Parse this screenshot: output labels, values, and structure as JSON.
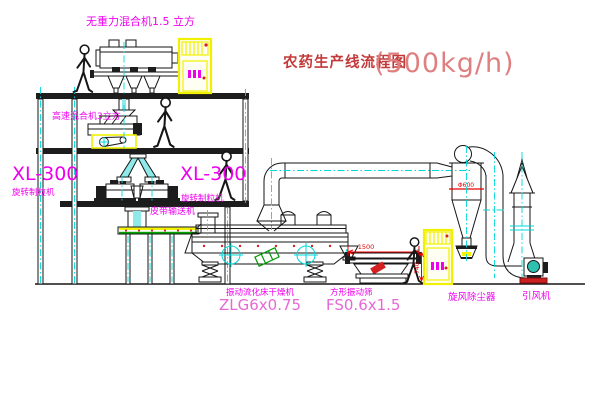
{
  "title": {
    "name_cn": "农药生产线流程图",
    "capacity": "(500kg/h)"
  },
  "equipment_labels": {
    "zero_gravity_mixer": "无重力混合机1.5 立方",
    "high_speed_mixer": "高速混合机3立方",
    "granulator_left": {
      "model": "XL-300",
      "name": "旋转制粒机"
    },
    "granulator_right": {
      "model": "XL-300",
      "name": "旋转制粒机"
    },
    "belt_conveyor": "皮带输送机",
    "fluid_bed_dryer": {
      "name": "振动流化床干燥机",
      "model": "ZLG6x0.75"
    },
    "vibrating_screen": {
      "name": "方形振动筛",
      "model": "FS0.6x1.5"
    },
    "cyclone_dust_collector": "旋风除尘器",
    "induced_draft_fan": "引风机"
  },
  "dimensions": {
    "screen_length_mm": "1500",
    "screen_height_mm": "740",
    "cyclone_marking": "Φ600"
  },
  "colors": {
    "label_magenta": "#ee00ee",
    "model_pink": "#e668d6",
    "title_red": "#c23a3a",
    "capacity_red": "#de8080",
    "dimension_red": "#e80000",
    "centerline_cyan": "#00d8d8",
    "cabinet_yellow": "#f2f200",
    "machine_green": "#009900"
  }
}
